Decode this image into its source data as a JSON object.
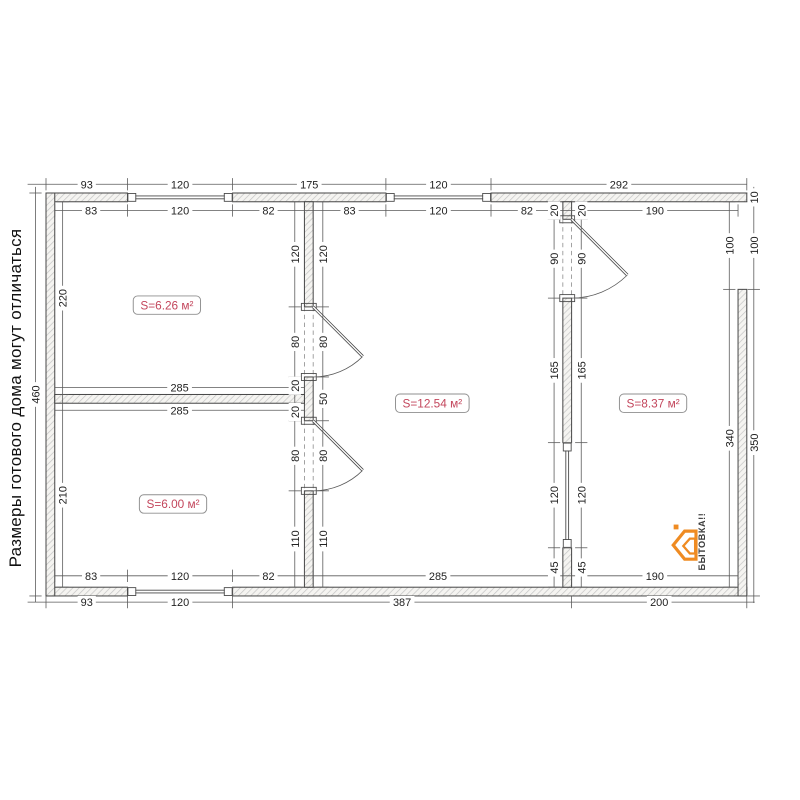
{
  "disclaimer": {
    "text": "Размеры готового дома могут отличаться"
  },
  "logo": {
    "text": "БЫТОВКА!!",
    "orange": "#ef8b22",
    "text_color": "#3d3d3d"
  },
  "colors": {
    "line": "#474747",
    "dim": "#5a5a5a",
    "dim_text": "#222222",
    "hatch_stripe": "#c4c4c4",
    "wall_fill": "#f5f4f1",
    "area_label": "#c3465c",
    "badge_border": "#8f8f8f"
  },
  "rooms": [
    {
      "name": "room-top-left",
      "area_label": "S=6.26 м²",
      "cx": 138,
      "cy": 128
    },
    {
      "name": "room-bottom-left",
      "area_label": "S=6.00 м²",
      "cx": 145,
      "cy": 355
    },
    {
      "name": "hall",
      "area_label": "S=12.54 м²",
      "cx": 441,
      "cy": 240
    },
    {
      "name": "room-right",
      "area_label": "S=8.37 м²",
      "cx": 693,
      "cy": 240
    }
  ],
  "plan": {
    "origin": [
      46,
      193
    ],
    "scale": 0.876,
    "walls": [
      [
        0,
        0,
        93,
        10
      ],
      [
        213,
        0,
        175,
        10
      ],
      [
        508,
        0,
        292,
        10
      ],
      [
        0,
        450,
        93,
        10
      ],
      [
        213,
        450,
        587,
        10
      ],
      [
        0,
        0,
        10,
        460
      ],
      [
        790,
        110,
        10,
        350
      ],
      [
        295,
        10,
        10,
        120
      ],
      [
        295,
        210,
        10,
        50
      ],
      [
        295,
        340,
        10,
        110
      ],
      [
        590,
        10,
        10,
        20
      ],
      [
        590,
        120,
        10,
        165
      ],
      [
        590,
        405,
        10,
        45
      ],
      [
        10,
        230,
        285,
        10
      ]
    ],
    "windows": [
      [
        93,
        0,
        120,
        10
      ],
      [
        388,
        0,
        120,
        10
      ],
      [
        93,
        450,
        120,
        10
      ],
      [
        590,
        285,
        10,
        120
      ]
    ],
    "doors": [
      {
        "gap": [
          295,
          130,
          10,
          80
        ],
        "hinge": [
          305,
          130
        ],
        "r": 80
      },
      {
        "gap": [
          295,
          260,
          10,
          80
        ],
        "hinge": [
          305,
          260
        ],
        "r": 80
      },
      {
        "gap": [
          590,
          30,
          10,
          90
        ],
        "hinge": [
          600,
          30
        ],
        "r": 90
      }
    ],
    "dims": [
      {
        "o": "h",
        "pos": -10,
        "ext": [
          -21,
          0
        ],
        "segs": [
          [
            0,
            93,
            "93"
          ],
          [
            93,
            213,
            "120"
          ],
          [
            213,
            388,
            "175"
          ],
          [
            388,
            508,
            "120"
          ],
          [
            508,
            800,
            "292"
          ]
        ]
      },
      {
        "o": "h",
        "pos": 20,
        "segs": [
          [
            10,
            93,
            "83"
          ],
          [
            93,
            213,
            "120"
          ],
          [
            213,
            295,
            "82"
          ],
          [
            305,
            388,
            "83"
          ],
          [
            388,
            508,
            "120"
          ],
          [
            508,
            590,
            "82"
          ],
          [
            600,
            790,
            "190"
          ]
        ]
      },
      {
        "o": "h",
        "pos": 222,
        "segs": [
          [
            10,
            295,
            "285"
          ]
        ]
      },
      {
        "o": "h",
        "pos": 248,
        "segs": [
          [
            10,
            295,
            "285"
          ]
        ]
      },
      {
        "o": "h",
        "pos": 437,
        "segs": [
          [
            10,
            93,
            "83"
          ],
          [
            93,
            213,
            "120"
          ],
          [
            213,
            295,
            "82"
          ],
          [
            305,
            590,
            "285"
          ],
          [
            600,
            790,
            "190"
          ]
        ]
      },
      {
        "o": "h",
        "pos": 467,
        "ext": [
          -21,
          9
        ],
        "segs": [
          [
            0,
            93,
            "93"
          ],
          [
            93,
            213,
            "120"
          ],
          [
            213,
            600,
            "387"
          ],
          [
            600,
            800,
            "200"
          ]
        ]
      },
      {
        "o": "v",
        "pos": -12,
        "ext": [
          -7,
          7
        ],
        "segs": [
          [
            0,
            460,
            "460"
          ]
        ]
      },
      {
        "o": "v",
        "pos": 19,
        "segs": [
          [
            10,
            230,
            "220"
          ],
          [
            240,
            450,
            "210"
          ]
        ]
      },
      {
        "o": "v",
        "pos": 284,
        "segs": [
          [
            10,
            130,
            "120"
          ],
          [
            130,
            210,
            "80"
          ],
          [
            210,
            230,
            "20"
          ],
          [
            240,
            260,
            "20"
          ],
          [
            260,
            340,
            "80"
          ],
          [
            340,
            450,
            "110"
          ]
        ]
      },
      {
        "o": "v",
        "pos": 316,
        "segs": [
          [
            10,
            130,
            "120"
          ],
          [
            130,
            210,
            "80"
          ],
          [
            210,
            260,
            "50"
          ],
          [
            260,
            340,
            "80"
          ],
          [
            340,
            450,
            "110"
          ]
        ]
      },
      {
        "o": "v",
        "pos": 580,
        "segs": [
          [
            10,
            30,
            "20"
          ],
          [
            30,
            120,
            "90"
          ],
          [
            120,
            285,
            "165"
          ],
          [
            285,
            405,
            "120"
          ],
          [
            405,
            450,
            "45"
          ]
        ]
      },
      {
        "o": "v",
        "pos": 611,
        "segs": [
          [
            10,
            30,
            "20"
          ],
          [
            30,
            120,
            "90"
          ],
          [
            120,
            285,
            "165"
          ],
          [
            285,
            405,
            "120"
          ],
          [
            405,
            450,
            "45"
          ]
        ]
      },
      {
        "o": "v",
        "pos": 780,
        "segs": [
          [
            10,
            110,
            "100"
          ],
          [
            110,
            450,
            "340"
          ]
        ]
      },
      {
        "o": "v",
        "pos": 808,
        "ext": [
          -7,
          8
        ],
        "segs": [
          [
            0,
            10,
            "10"
          ],
          [
            10,
            110,
            "100"
          ],
          [
            110,
            460,
            "350"
          ]
        ]
      }
    ]
  }
}
